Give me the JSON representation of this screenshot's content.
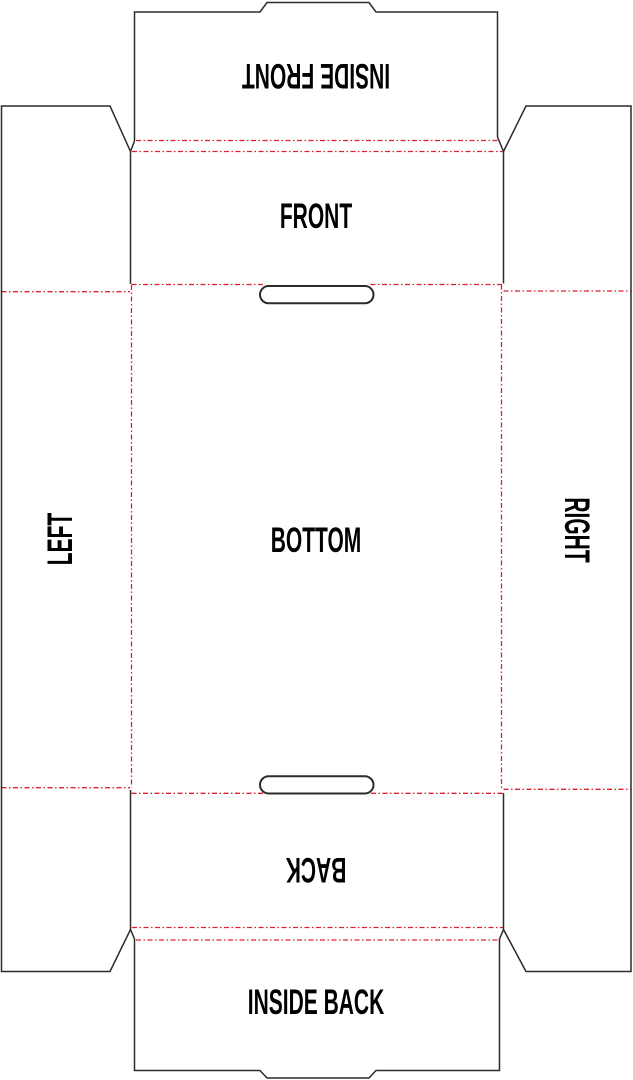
{
  "diagram": {
    "type": "box-dieline-template",
    "panels": {
      "inside_front": "INSIDE FRONT",
      "front": "FRONT",
      "left": "LEFT",
      "bottom": "BOTTOM",
      "right": "RIGHT",
      "back": "BACK",
      "inside_back": "INSIDE BACK"
    },
    "colors": {
      "cut_line": "#2b2b2b",
      "fold_line": "#dd2030",
      "label_text": "#000000",
      "background": "#ffffff"
    }
  }
}
